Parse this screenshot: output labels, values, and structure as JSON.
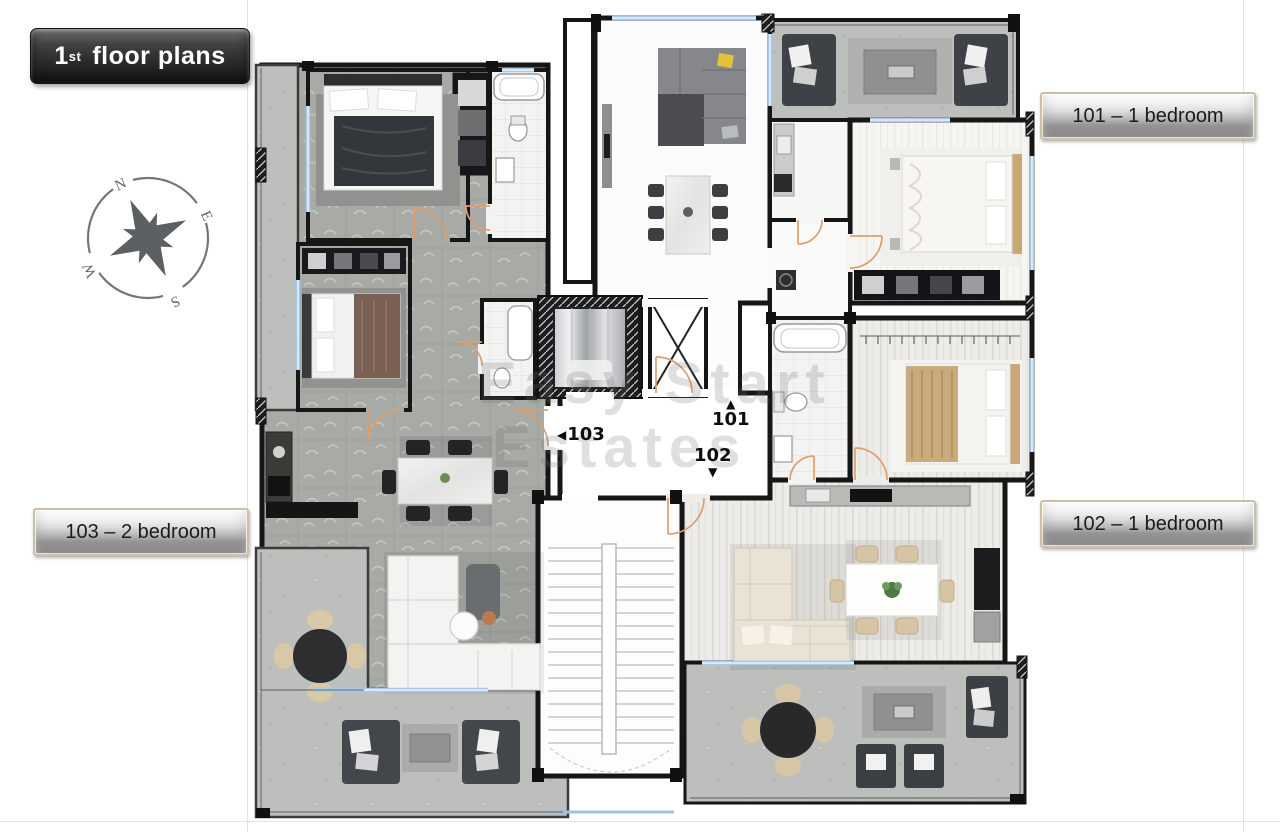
{
  "title": {
    "number": "1",
    "ordinal": "st",
    "text": "floor plans"
  },
  "compass": {
    "north": "N",
    "east": "E",
    "south": "S",
    "west": "W"
  },
  "unit_buttons": [
    {
      "id": "101",
      "label": "101 – 1 bedroom"
    },
    {
      "id": "102",
      "label": "102 – 1 bedroom"
    },
    {
      "id": "103",
      "label": "103 – 2 bedroom"
    }
  ],
  "plan_labels": {
    "unit101": {
      "arrow": "▲",
      "number": "101"
    },
    "unit102": {
      "number": "102",
      "arrow": "▼"
    },
    "unit103": {
      "arrow": "◀",
      "number": "103"
    }
  },
  "watermark": {
    "line1": "Easy Start",
    "line2": "Estates"
  },
  "colors": {
    "wall": "#161616",
    "door_arc": "#dd9e70",
    "window": "#a9c7e8",
    "floor_pattern": "#a7aaa5",
    "concrete": "#bcbfbb",
    "button_border": "#cdbfa4",
    "title_background": "#2a2a2a",
    "silver_button": "#c2c2c2"
  }
}
